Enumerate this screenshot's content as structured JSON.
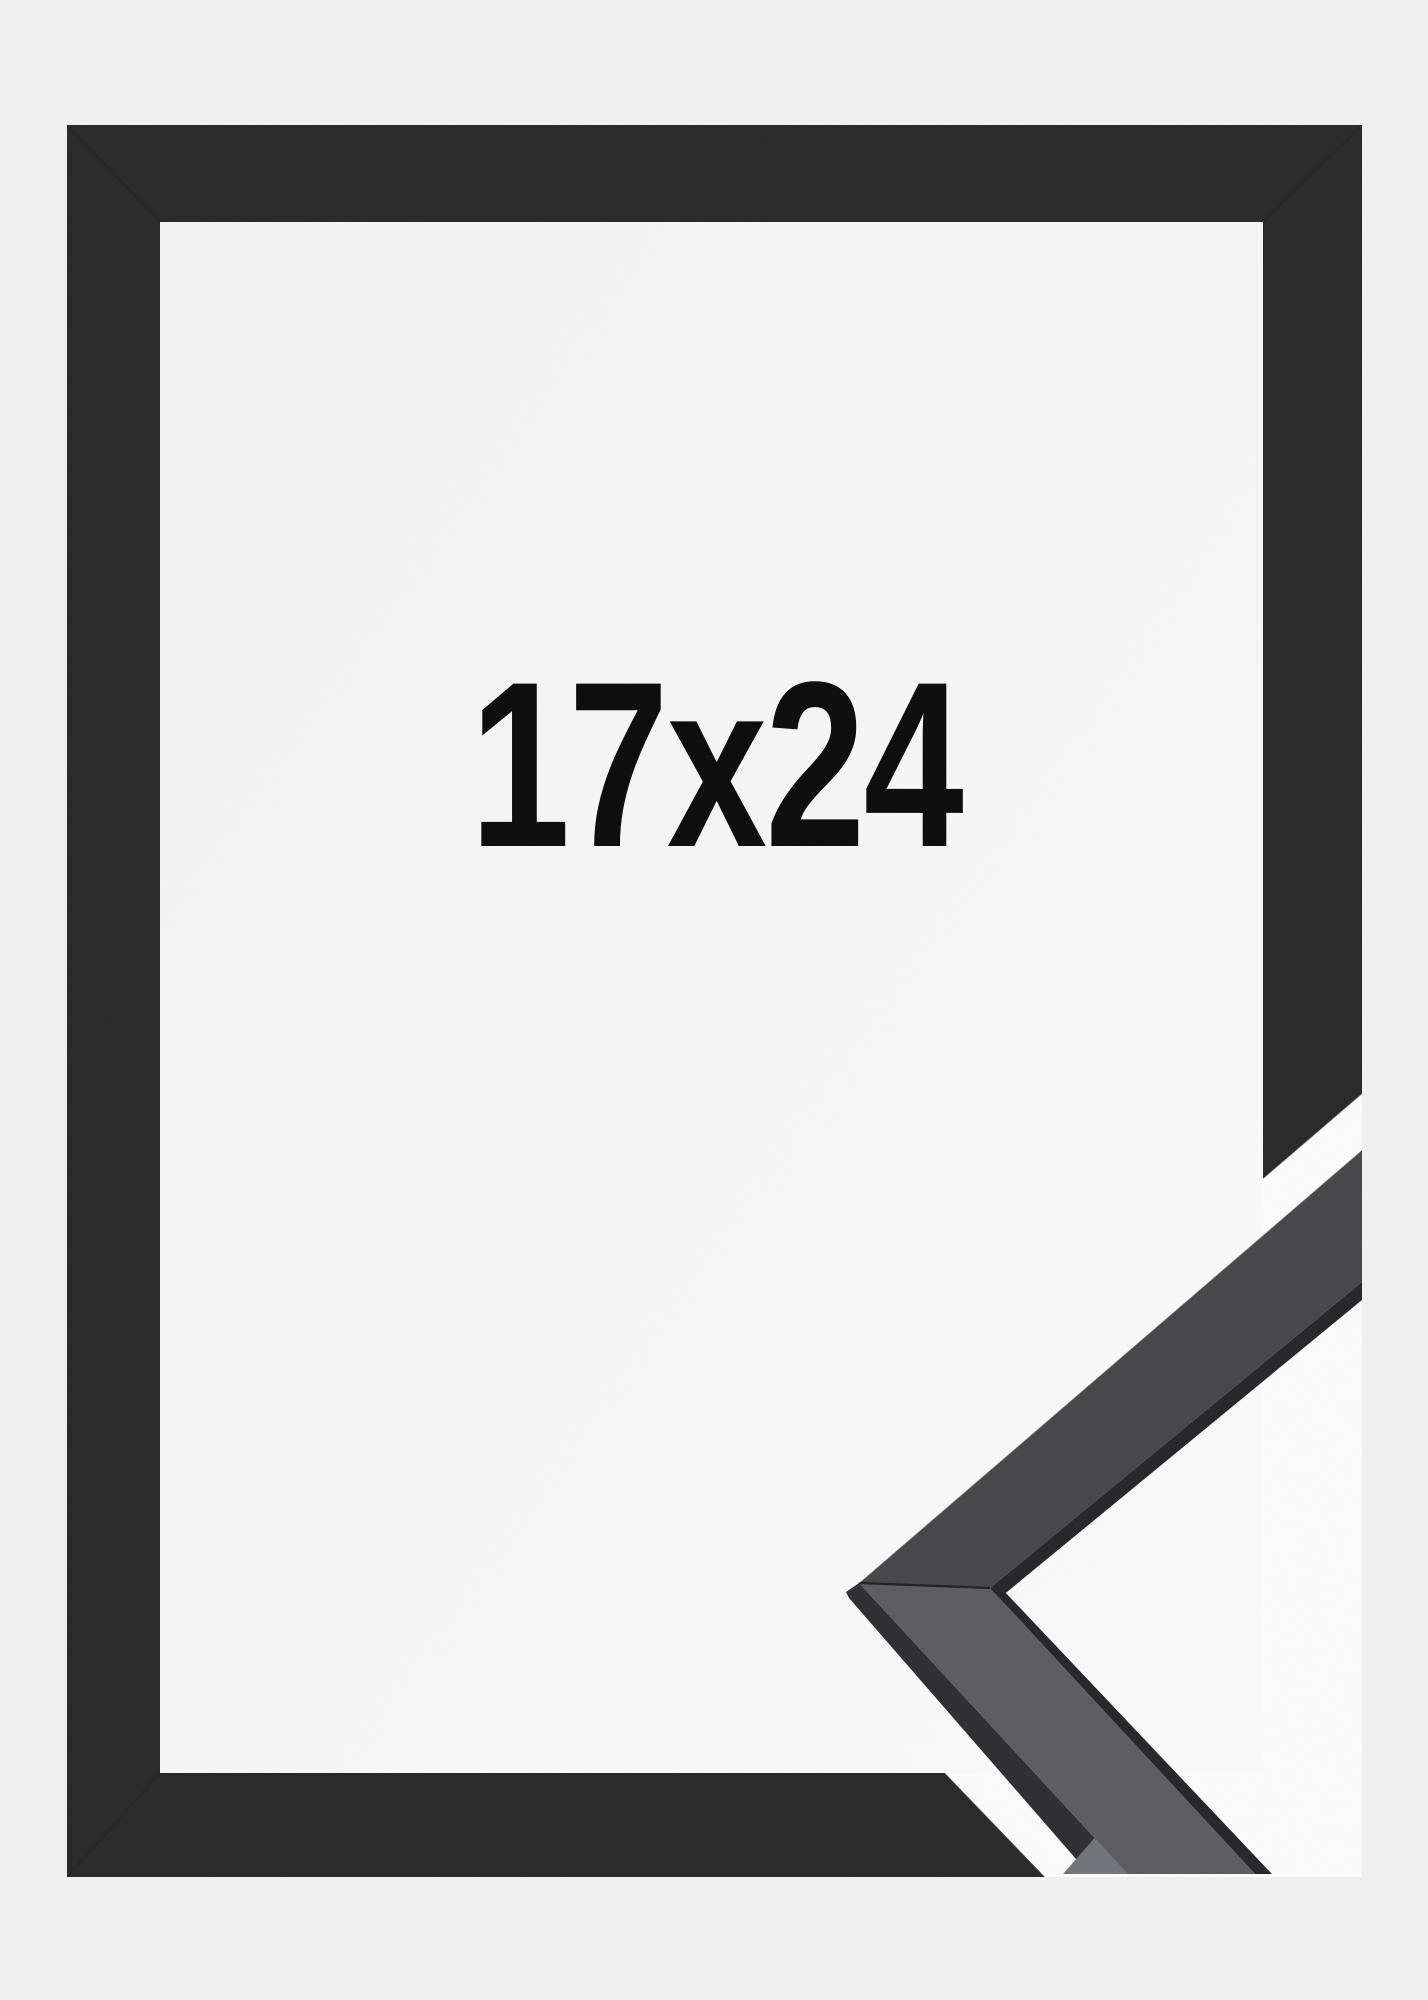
{
  "product": {
    "size_label": "17x24"
  },
  "colors": {
    "background": "#f0f0f1",
    "opening_background": "#f2f2f3",
    "opening_glow": "#fafafb",
    "cutout_background": "#fcfcfd",
    "frame_face": "#282829",
    "sample_upper_face": "#46464a",
    "sample_lower_face": "#5c5c60",
    "sample_shadow_side": "#2e2e31",
    "sample_end_facet": "#73737b",
    "sample_lip": "#26262a",
    "label_color": "#0b0b0c"
  }
}
